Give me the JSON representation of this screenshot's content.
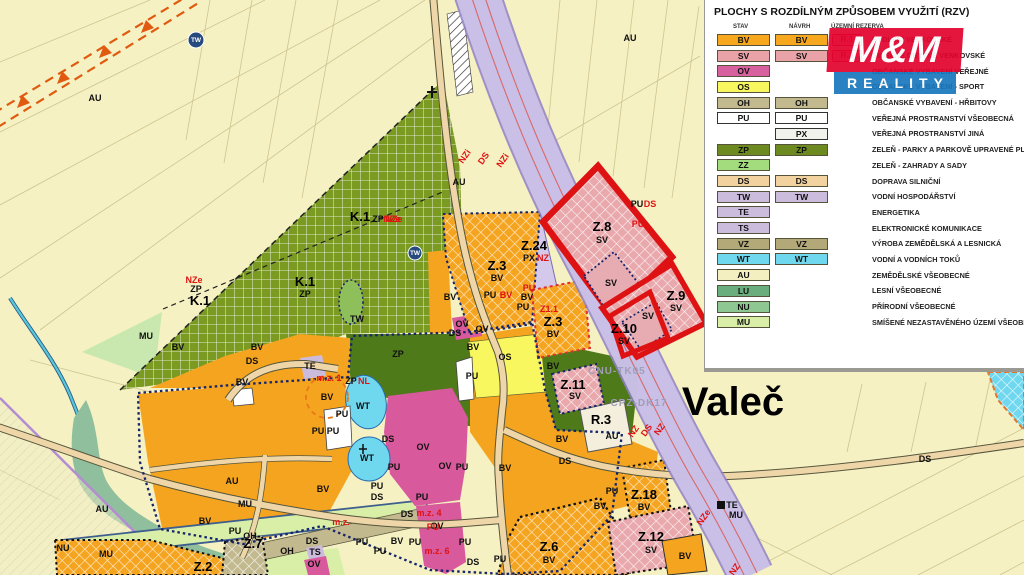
{
  "map": {
    "town_label": "Valeč",
    "corridor_codes": [
      "CNU-TK05",
      "CPZ-DK17"
    ],
    "labels": [
      {
        "t": "Valeč",
        "x": 733,
        "y": 415,
        "c": "v"
      },
      {
        "t": "Z.8",
        "x": 602,
        "y": 231,
        "c": "z"
      },
      {
        "t": "SV",
        "x": 602,
        "y": 243,
        "c": "s"
      },
      {
        "t": "Z.9",
        "x": 676,
        "y": 300,
        "c": "z"
      },
      {
        "t": "SV",
        "x": 676,
        "y": 311,
        "c": "s"
      },
      {
        "t": "Z.10",
        "x": 624,
        "y": 333,
        "c": "z"
      },
      {
        "t": "SV",
        "x": 624,
        "y": 344,
        "c": "s"
      },
      {
        "t": "SV",
        "x": 611,
        "y": 286,
        "c": "s"
      },
      {
        "t": "SV",
        "x": 648,
        "y": 319,
        "c": "s"
      },
      {
        "t": "Z.3",
        "x": 497,
        "y": 270,
        "c": "z"
      },
      {
        "t": "BV",
        "x": 497,
        "y": 281,
        "c": "s"
      },
      {
        "t": "Z.3",
        "x": 553,
        "y": 326,
        "c": "z"
      },
      {
        "t": "BV",
        "x": 553,
        "y": 337,
        "c": "s"
      },
      {
        "t": "Z1.1",
        "x": 549,
        "y": 312,
        "c": "r"
      },
      {
        "t": "Z.24",
        "x": 534,
        "y": 250,
        "c": "z"
      },
      {
        "t": "PX",
        "x": 529,
        "y": 261,
        "c": "s"
      },
      {
        "t": "NZ",
        "x": 543,
        "y": 261,
        "c": "r"
      },
      {
        "t": "Z.11",
        "x": 573,
        "y": 389,
        "c": "z"
      },
      {
        "t": "SV",
        "x": 575,
        "y": 399,
        "c": "s"
      },
      {
        "t": "Z.18",
        "x": 644,
        "y": 499,
        "c": "z"
      },
      {
        "t": "BV",
        "x": 644,
        "y": 510,
        "c": "s"
      },
      {
        "t": "Z.12",
        "x": 651,
        "y": 541,
        "c": "z"
      },
      {
        "t": "SV",
        "x": 651,
        "y": 553,
        "c": "s"
      },
      {
        "t": "Z.6",
        "x": 549,
        "y": 551,
        "c": "z"
      },
      {
        "t": "BV",
        "x": 549,
        "y": 563,
        "c": "s"
      },
      {
        "t": "Z.2",
        "x": 203,
        "y": 571,
        "c": "z"
      },
      {
        "t": "Z.7",
        "x": 253,
        "y": 548,
        "c": "z"
      },
      {
        "t": "R.3",
        "x": 601,
        "y": 424,
        "c": "z"
      },
      {
        "t": "K.1",
        "x": 360,
        "y": 221,
        "c": "z"
      },
      {
        "t": "ZP",
        "x": 378,
        "y": 222,
        "c": "s"
      },
      {
        "t": "NZe",
        "x": 394,
        "y": 222,
        "c": "r"
      },
      {
        "t": "K.1",
        "x": 305,
        "y": 286,
        "c": "z"
      },
      {
        "t": "ZP",
        "x": 305,
        "y": 297,
        "c": "s"
      },
      {
        "t": "K.1",
        "x": 200,
        "y": 305,
        "c": "z"
      },
      {
        "t": "ZP",
        "x": 196,
        "y": 292,
        "c": "s"
      },
      {
        "t": "NZe",
        "x": 194,
        "y": 283,
        "c": "r"
      },
      {
        "t": "AU",
        "x": 95,
        "y": 101,
        "c": "s"
      },
      {
        "t": "AU",
        "x": 630,
        "y": 41,
        "c": "s"
      },
      {
        "t": "AU",
        "x": 459,
        "y": 185,
        "c": "s"
      },
      {
        "t": "AU",
        "x": 612,
        "y": 439,
        "c": "s"
      },
      {
        "t": "AU",
        "x": 232,
        "y": 484,
        "c": "s"
      },
      {
        "t": "AU",
        "x": 102,
        "y": 512,
        "c": "s"
      },
      {
        "t": "MU",
        "x": 146,
        "y": 339,
        "c": "s"
      },
      {
        "t": "MU",
        "x": 245,
        "y": 507,
        "c": "s"
      },
      {
        "t": "MU",
        "x": 106,
        "y": 557,
        "c": "s"
      },
      {
        "t": "MU",
        "x": 736,
        "y": 518,
        "c": "s"
      },
      {
        "t": "NU",
        "x": 63,
        "y": 551,
        "c": "s"
      },
      {
        "t": "BV",
        "x": 178,
        "y": 350,
        "c": "s"
      },
      {
        "t": "BV",
        "x": 257,
        "y": 350,
        "c": "s"
      },
      {
        "t": "BV",
        "x": 242,
        "y": 385,
        "c": "s"
      },
      {
        "t": "BV",
        "x": 327,
        "y": 400,
        "c": "s"
      },
      {
        "t": "BV",
        "x": 323,
        "y": 492,
        "c": "s"
      },
      {
        "t": "BV",
        "x": 397,
        "y": 544,
        "c": "s"
      },
      {
        "t": "BV",
        "x": 450,
        "y": 300,
        "c": "s"
      },
      {
        "t": "BV",
        "x": 473,
        "y": 350,
        "c": "s"
      },
      {
        "t": "BV",
        "x": 505,
        "y": 471,
        "c": "s"
      },
      {
        "t": "BV",
        "x": 562,
        "y": 442,
        "c": "s"
      },
      {
        "t": "BV",
        "x": 600,
        "y": 509,
        "c": "s"
      },
      {
        "t": "BV",
        "x": 685,
        "y": 559,
        "c": "s"
      },
      {
        "t": "BV",
        "x": 205,
        "y": 524,
        "c": "s"
      },
      {
        "t": "BV",
        "x": 553,
        "y": 369,
        "c": "s"
      },
      {
        "t": "BV",
        "x": 527,
        "y": 300,
        "c": "s"
      },
      {
        "t": "PU",
        "x": 342,
        "y": 417,
        "c": "s"
      },
      {
        "t": "PU",
        "x": 318,
        "y": 434,
        "c": "s"
      },
      {
        "t": "PU",
        "x": 333,
        "y": 434,
        "c": "s"
      },
      {
        "t": "PU",
        "x": 377,
        "y": 489,
        "c": "s"
      },
      {
        "t": "PU",
        "x": 394,
        "y": 470,
        "c": "s"
      },
      {
        "t": "PU",
        "x": 422,
        "y": 500,
        "c": "s"
      },
      {
        "t": "PU",
        "x": 462,
        "y": 470,
        "c": "s"
      },
      {
        "t": "PU",
        "x": 472,
        "y": 379,
        "c": "s"
      },
      {
        "t": "PU",
        "x": 490,
        "y": 298,
        "c": "s"
      },
      {
        "t": "PU",
        "x": 523,
        "y": 310,
        "c": "s"
      },
      {
        "t": "PU",
        "x": 637,
        "y": 207,
        "c": "s"
      },
      {
        "t": "PU",
        "x": 612,
        "y": 494,
        "c": "s"
      },
      {
        "t": "PU",
        "x": 362,
        "y": 545,
        "c": "s"
      },
      {
        "t": "PU",
        "x": 380,
        "y": 554,
        "c": "s"
      },
      {
        "t": "PU",
        "x": 415,
        "y": 545,
        "c": "s"
      },
      {
        "t": "PU",
        "x": 465,
        "y": 545,
        "c": "s"
      },
      {
        "t": "PU",
        "x": 500,
        "y": 562,
        "c": "s"
      },
      {
        "t": "PU",
        "x": 235,
        "y": 534,
        "c": "s"
      },
      {
        "t": "OV",
        "x": 423,
        "y": 450,
        "c": "s"
      },
      {
        "t": "OV",
        "x": 445,
        "y": 469,
        "c": "s"
      },
      {
        "t": "OV",
        "x": 437,
        "y": 529,
        "c": "s"
      },
      {
        "t": "OV",
        "x": 462,
        "y": 327,
        "c": "s"
      },
      {
        "t": "OV",
        "x": 482,
        "y": 332,
        "c": "s"
      },
      {
        "t": "OV",
        "x": 314,
        "y": 567,
        "c": "s"
      },
      {
        "t": "DS",
        "x": 252,
        "y": 364,
        "c": "s"
      },
      {
        "t": "DS",
        "x": 388,
        "y": 442,
        "c": "s"
      },
      {
        "t": "DS",
        "x": 377,
        "y": 500,
        "c": "s"
      },
      {
        "t": "DS",
        "x": 407,
        "y": 517,
        "c": "s"
      },
      {
        "t": "DS",
        "x": 455,
        "y": 336,
        "c": "s"
      },
      {
        "t": "DS",
        "x": 473,
        "y": 565,
        "c": "s"
      },
      {
        "t": "DS",
        "x": 565,
        "y": 464,
        "c": "s"
      },
      {
        "t": "DS",
        "x": 925,
        "y": 462,
        "c": "s"
      },
      {
        "t": "DS",
        "x": 312,
        "y": 544,
        "c": "s"
      },
      {
        "t": "OH",
        "x": 250,
        "y": 539,
        "c": "s"
      },
      {
        "t": "OH",
        "x": 287,
        "y": 554,
        "c": "s"
      },
      {
        "t": "TS",
        "x": 315,
        "y": 555,
        "c": "s"
      },
      {
        "t": "TE",
        "x": 310,
        "y": 369,
        "c": "s"
      },
      {
        "t": "TE",
        "x": 732,
        "y": 508,
        "c": "s"
      },
      {
        "t": "TW",
        "x": 357,
        "y": 322,
        "c": "s"
      },
      {
        "t": "WT",
        "x": 363,
        "y": 409,
        "c": "s"
      },
      {
        "t": "WT",
        "x": 367,
        "y": 461,
        "c": "s"
      },
      {
        "t": "OS",
        "x": 505,
        "y": 360,
        "c": "s"
      },
      {
        "t": "NZe",
        "x": 392,
        "y": 222,
        "c": "r"
      },
      {
        "t": "NL",
        "x": 364,
        "y": 384,
        "c": "r"
      },
      {
        "t": "ZP",
        "x": 351,
        "y": 384,
        "c": "s"
      },
      {
        "t": "ZP",
        "x": 398,
        "y": 357,
        "c": "s"
      },
      {
        "t": "DS",
        "x": 650,
        "y": 207,
        "c": "r"
      },
      {
        "t": "PU",
        "x": 638,
        "y": 227,
        "c": "r"
      },
      {
        "t": "PU",
        "x": 529,
        "y": 291,
        "c": "r"
      },
      {
        "t": "BV",
        "x": 506,
        "y": 298,
        "c": "r"
      },
      {
        "t": "PU",
        "x": 433,
        "y": 530,
        "c": "r"
      },
      {
        "t": "m.z. 1",
        "x": 329,
        "y": 381,
        "c": "r"
      },
      {
        "t": "m.z. 4",
        "x": 429,
        "y": 516,
        "c": "r"
      },
      {
        "t": "m.z.",
        "x": 341,
        "y": 525,
        "c": "r"
      },
      {
        "t": "m.z. 6",
        "x": 437,
        "y": 554,
        "c": "r"
      },
      {
        "t": "NZi",
        "x": 467,
        "y": 158,
        "c": "r",
        "r": -55
      },
      {
        "t": "DS",
        "x": 486,
        "y": 160,
        "c": "r",
        "r": -55
      },
      {
        "t": "NZi",
        "x": 505,
        "y": 162,
        "c": "r",
        "r": -55
      },
      {
        "t": "NZ",
        "x": 636,
        "y": 433,
        "c": "r",
        "r": -55
      },
      {
        "t": "DS",
        "x": 649,
        "y": 432,
        "c": "r",
        "r": -55
      },
      {
        "t": "NZ",
        "x": 662,
        "y": 431,
        "c": "r",
        "r": -55
      },
      {
        "t": "NZe",
        "x": 706,
        "y": 519,
        "c": "r",
        "r": -55
      },
      {
        "t": "NZ",
        "x": 737,
        "y": 571,
        "c": "r",
        "r": -55
      },
      {
        "t": "CNU-TK05",
        "x": 617,
        "y": 374,
        "c": "g"
      },
      {
        "t": "CPZ-DK17",
        "x": 639,
        "y": 406,
        "c": "g"
      },
      {
        "t": "TW",
        "x": 196,
        "y": 42,
        "c": "i"
      },
      {
        "t": "TW",
        "x": 415,
        "y": 255,
        "c": "i"
      }
    ]
  },
  "legend": {
    "title": "PLOCHY S ROZDÍLNÝM ZPŮSOBEM VYUŽITÍ (RZV)",
    "columns": [
      "STAV",
      "NÁVRH",
      "ÚZEMNÍ REZERVA"
    ],
    "rows": [
      {
        "code": "BV",
        "stav": "#F7A81E",
        "navrh": "#F7A81E",
        "hatch": true,
        "reserve": "R-1",
        "label": "BYDLENÍ VENKOVSKÉ"
      },
      {
        "code": "SV",
        "stav": "#E9A3A8",
        "navrh": "#E9A3A8",
        "hatch": true,
        "reserve": "R-3",
        "label": "SMÍŠENÉ OBYTNÉ VENKOVSKÉ"
      },
      {
        "code": "OV",
        "stav": "#D6619E",
        "navrh": null,
        "hatch": false,
        "reserve": null,
        "label": "OBČANSKÉ VYBAVENÍ VEŘEJNÉ"
      },
      {
        "code": "OS",
        "stav": "#F9F75F",
        "navrh": null,
        "hatch": false,
        "reserve": null,
        "label": "OBČANSKÉ VYBAVENÍ - SPORT"
      },
      {
        "code": "OH",
        "stav": "#C2B98E",
        "navrh": "#C2B98E",
        "hatch": true,
        "reserve": null,
        "label": "OBČANSKÉ VYBAVENÍ - HŘBITOVY"
      },
      {
        "code": "PU",
        "stav": "#FFFFFF",
        "navrh": "#FFFFFF",
        "hatch": false,
        "reserve": null,
        "label": "VEŘEJNÁ PROSTRANSTVÍ VŠEOBECNÁ"
      },
      {
        "code": "PX",
        "stav": null,
        "navrh": "#F2F2EC",
        "hatch": false,
        "reserve": null,
        "label": "VEŘEJNÁ PROSTRANSTVÍ JINÁ"
      },
      {
        "code": "ZP",
        "stav": "#6C8A1F",
        "navrh": "#6C8A1F",
        "hatch": true,
        "reserve": null,
        "label": "ZELEŇ - PARKY A PARKOVĚ UPRAVENÉ PLOCHY"
      },
      {
        "code": "ZZ",
        "stav": "#A2DC7C",
        "navrh": null,
        "hatch": false,
        "reserve": null,
        "label": "ZELEŇ - ZAHRADY A SADY"
      },
      {
        "code": "DS",
        "stav": "#F2D3A0",
        "navrh": "#F2D3A0",
        "hatch": true,
        "reserve": null,
        "label": "DOPRAVA SILNIČNÍ"
      },
      {
        "code": "TW",
        "stav": "#CBBBDC",
        "navrh": "#CBBBDC",
        "hatch": true,
        "reserve": null,
        "label": "VODNÍ HOSPODÁŘSTVÍ"
      },
      {
        "code": "TE",
        "stav": "#CBBBDC",
        "navrh": null,
        "hatch": false,
        "reserve": null,
        "label": "ENERGETIKA"
      },
      {
        "code": "TS",
        "stav": "#CBBBDC",
        "navrh": null,
        "hatch": false,
        "reserve": null,
        "label": "ELEKTRONICKÉ KOMUNIKACE"
      },
      {
        "code": "VZ",
        "stav": "#B3A878",
        "navrh": "#B3A878",
        "hatch": true,
        "reserve": null,
        "label": "VÝROBA ZEMĚDĚLSKÁ A LESNICKÁ"
      },
      {
        "code": "WT",
        "stav": "#6FD8EF",
        "navrh": "#6FD8EF",
        "hatch": true,
        "reserve": null,
        "label": "VODNÍ A VODNÍCH TOKŮ"
      },
      {
        "code": "AU",
        "stav": "#F4EFC0",
        "navrh": null,
        "hatch": false,
        "reserve": null,
        "label": "ZEMĚDĚLSKÉ VŠEOBECNÉ"
      },
      {
        "code": "LU",
        "stav": "#69AE7C",
        "navrh": null,
        "hatch": false,
        "reserve": null,
        "label": "LESNÍ VŠEOBECNÉ"
      },
      {
        "code": "NU",
        "stav": "#8FC792",
        "navrh": null,
        "hatch": false,
        "reserve": null,
        "label": "PŘÍRODNÍ VŠEOBECNÉ"
      },
      {
        "code": "MU",
        "stav": "#D9EFA8",
        "navrh": null,
        "hatch": false,
        "reserve": null,
        "label": "SMÍŠENÉ NEZASTAVĚNÉHO ÚZEMÍ VŠEOBECNÉ"
      }
    ]
  },
  "logo": {
    "line1": "M&M",
    "line2": "REALITY",
    "red": "#E3032E",
    "blue": "#1878BE"
  },
  "colors": {
    "background": "#F5F1C3",
    "village": "#F5A41F",
    "corridor": "#CDC3E8",
    "change_zone_border": "#DE1212",
    "built_boundary": "#16246B"
  }
}
